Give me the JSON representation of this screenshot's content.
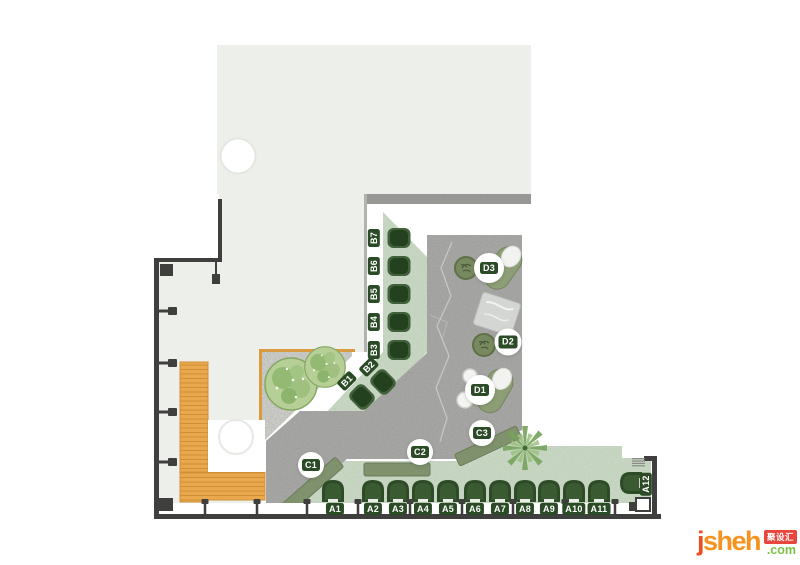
{
  "floor_plan": {
    "seats": {
      "a": [
        "A1",
        "A2",
        "A3",
        "A4",
        "A5",
        "A6",
        "A7",
        "A8",
        "A9",
        "A10",
        "A11"
      ],
      "a_side": "A12",
      "b": [
        "B1",
        "B2",
        "B3",
        "B4",
        "B5",
        "B6",
        "B7"
      ],
      "benches": [
        "C1",
        "C2",
        "C3"
      ],
      "lounge": [
        "D1",
        "D2",
        "D3"
      ]
    },
    "watermark": {
      "brand_j": "j",
      "brand_rest": "sheh",
      "tld": ".com",
      "badge": "聚设汇"
    },
    "colors": {
      "floor": "#edefeb",
      "concrete": "#acacaa",
      "seating_band": "#cbdcc6",
      "bench": "#7f916d",
      "chair": "#2e4b28",
      "counter": "#e9a84d",
      "wall": "#3f3f3d",
      "brand_orange": "#f6921e",
      "brand_green": "#7ac143",
      "badge_red": "#e8453c"
    }
  }
}
